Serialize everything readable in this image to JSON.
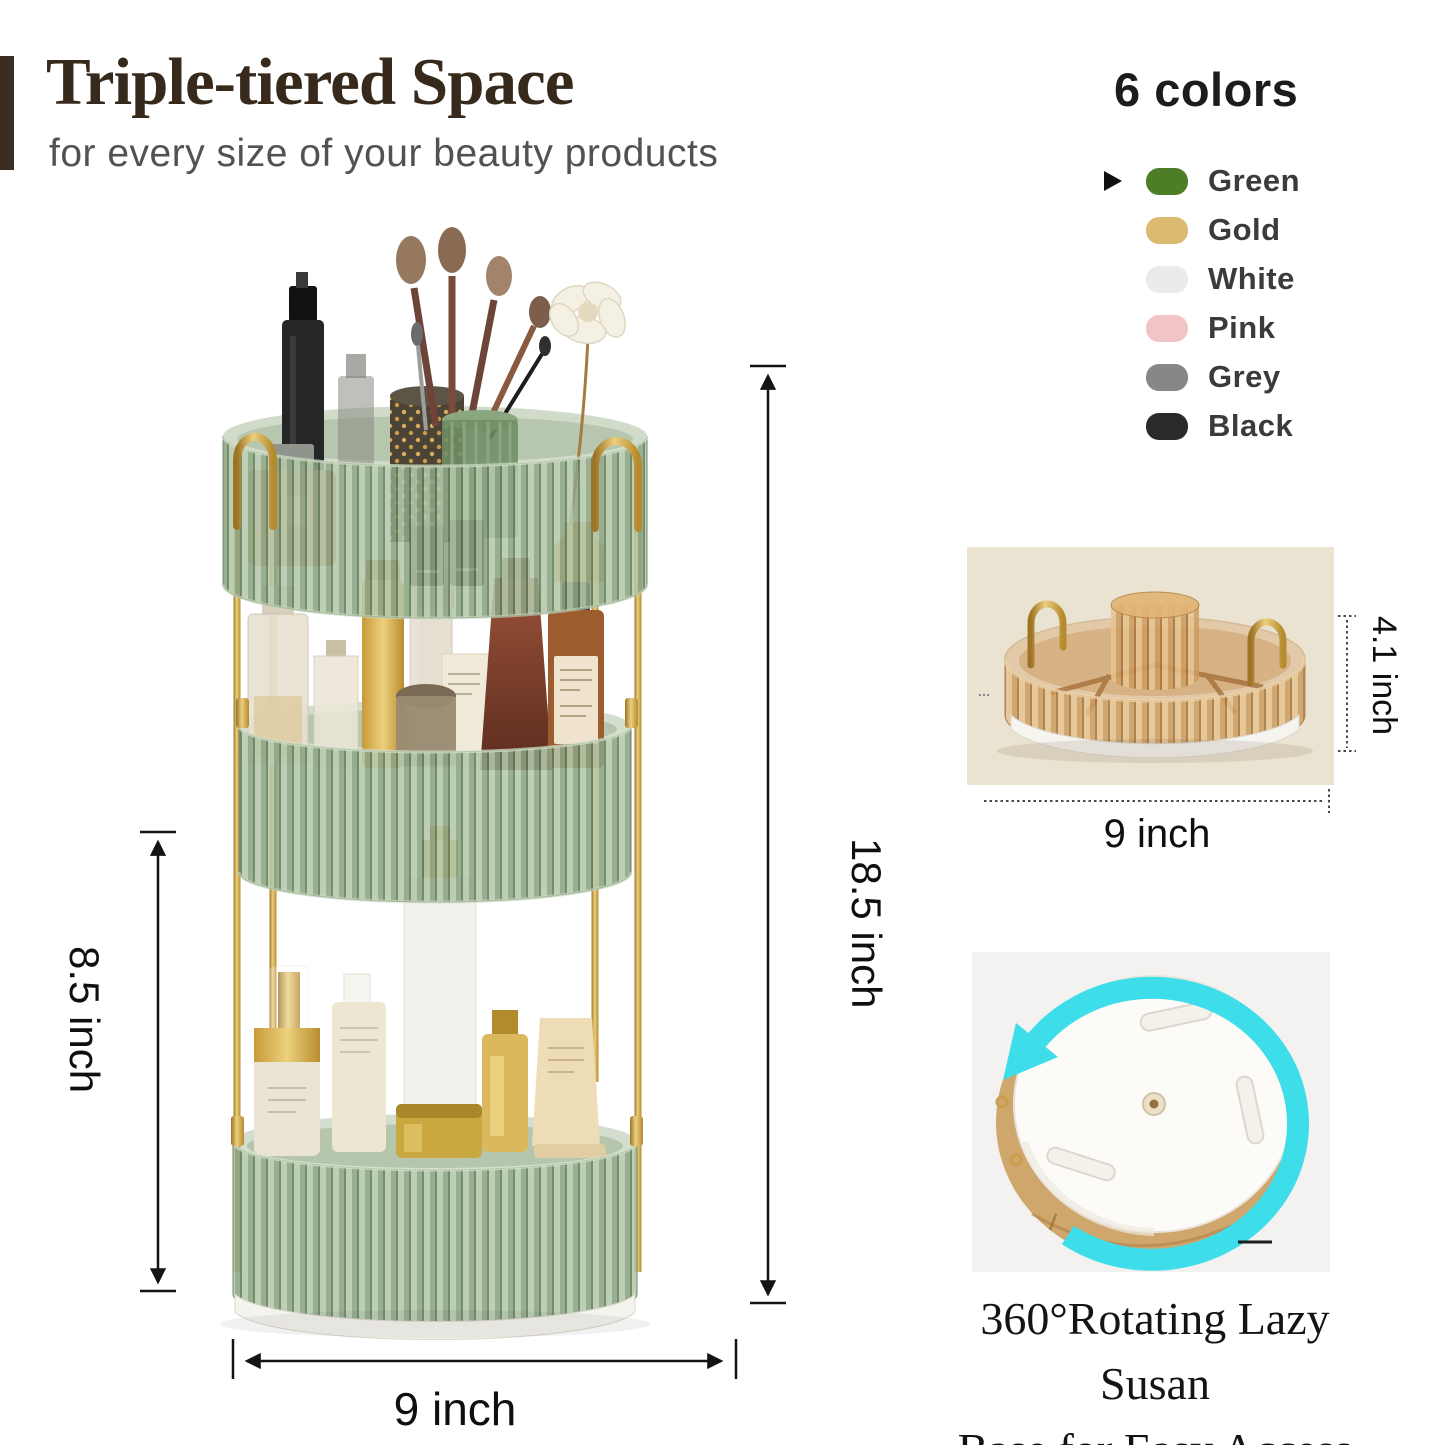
{
  "header": {
    "title": "Triple-tiered Space",
    "subtitle": "for every size of your beauty products"
  },
  "colors_panel": {
    "heading": "6 colors",
    "selected_label": "Green",
    "options": [
      {
        "label": "Green",
        "hex": "#4e7d28"
      },
      {
        "label": "Gold",
        "hex": "#dcba72"
      },
      {
        "label": "White",
        "hex": "#ecebe9"
      },
      {
        "label": "Pink",
        "hex": "#f2c4c6"
      },
      {
        "label": "Grey",
        "hex": "#878787"
      },
      {
        "label": "Black",
        "hex": "#2a2a2a"
      }
    ]
  },
  "main_product": {
    "total_height": "18.5 inch",
    "tier_height": "8.5 inch",
    "width": "9 inch"
  },
  "tray_detail": {
    "height": "4.1 inch",
    "width": "9 inch"
  },
  "base_detail": {
    "caption_line1": "360°Rotating Lazy Susan",
    "caption_line2": "Base for Easy Access"
  }
}
